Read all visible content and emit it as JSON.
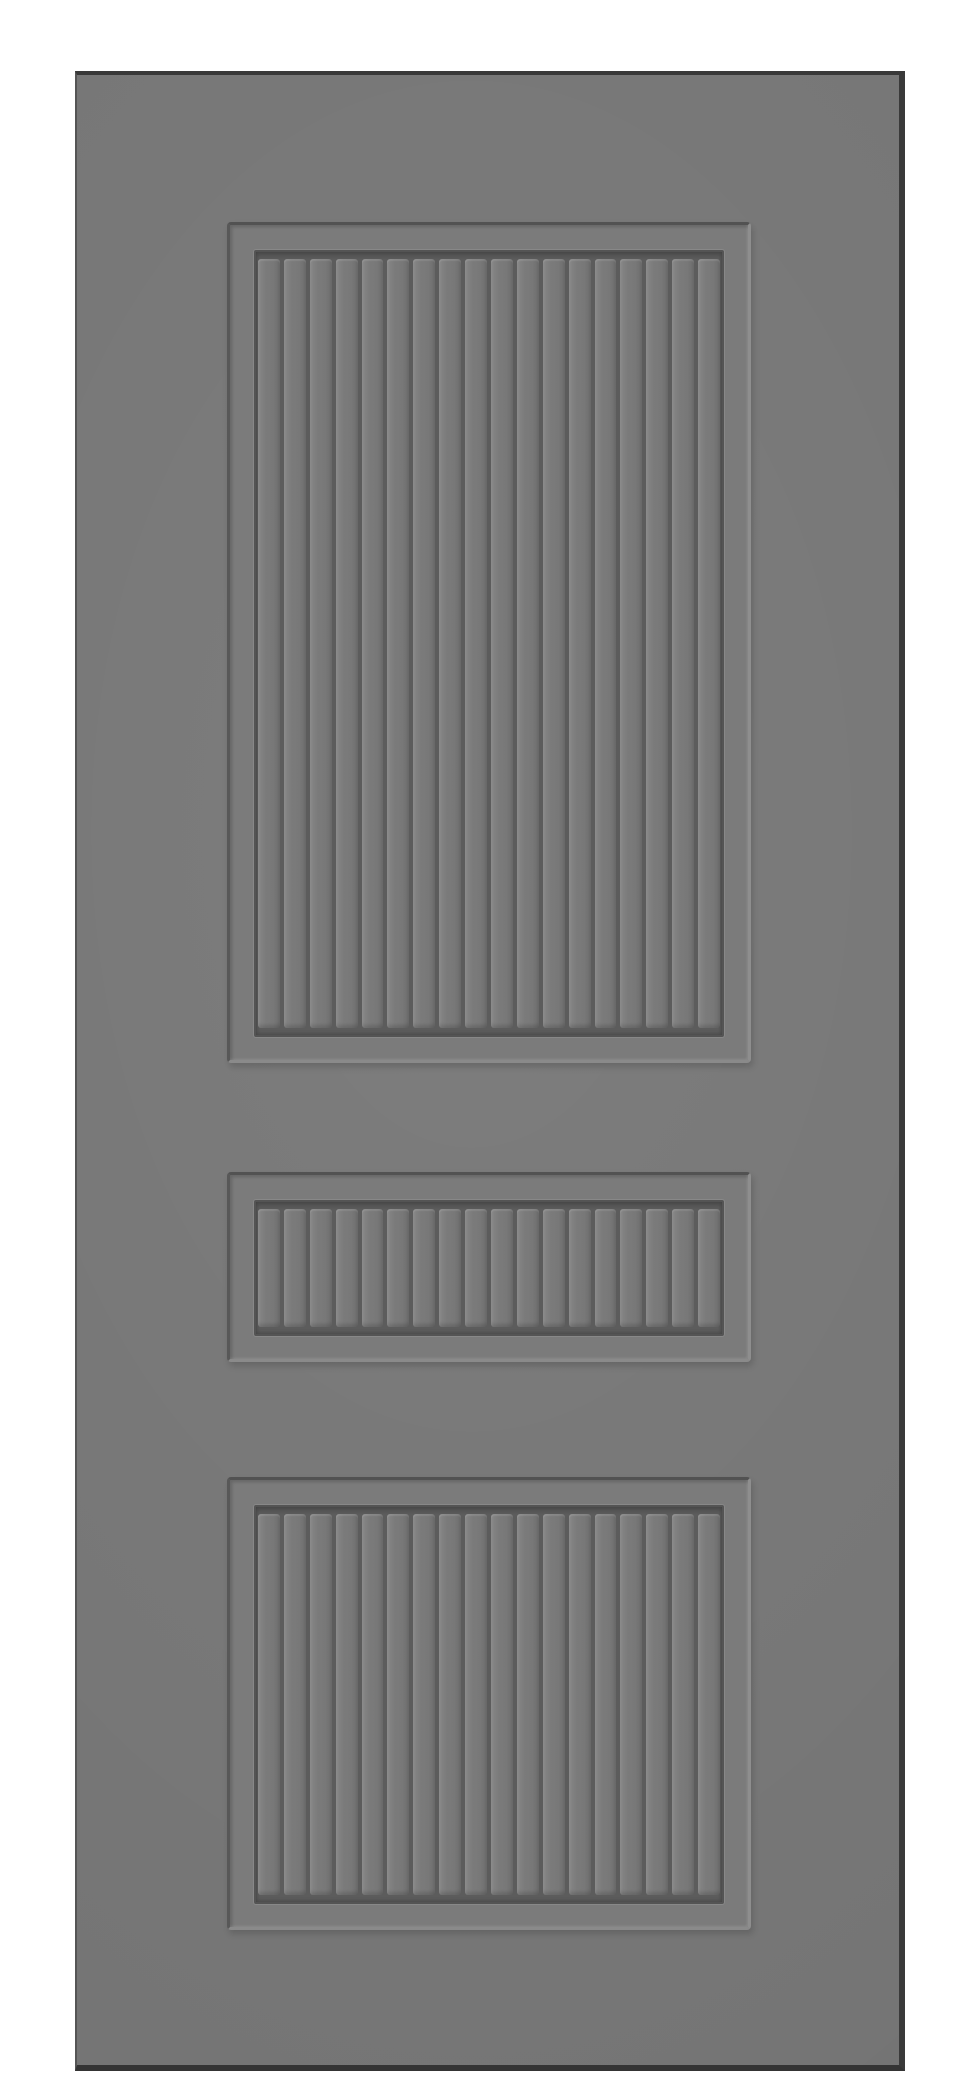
{
  "scene": {
    "type": "product-render",
    "subject": "gray three-panel interior door slab, front view, on plain white background",
    "background_color": "#ffffff"
  },
  "door": {
    "face_color": "#797979",
    "edge_shadow_color": "#3a3a3a",
    "groove_color": "#5c5c5c",
    "groove_highlight_color": "#949494",
    "panel_bevel_dark": "#525252",
    "panel_bevel_light": "#8e8e8e",
    "panels": [
      {
        "id": "top",
        "style": "tall grooved panel",
        "slat_count": 18
      },
      {
        "id": "middle",
        "style": "short grooved panel",
        "slat_count": 18
      },
      {
        "id": "bottom",
        "style": "large grooved panel",
        "slat_count": 18
      }
    ]
  }
}
